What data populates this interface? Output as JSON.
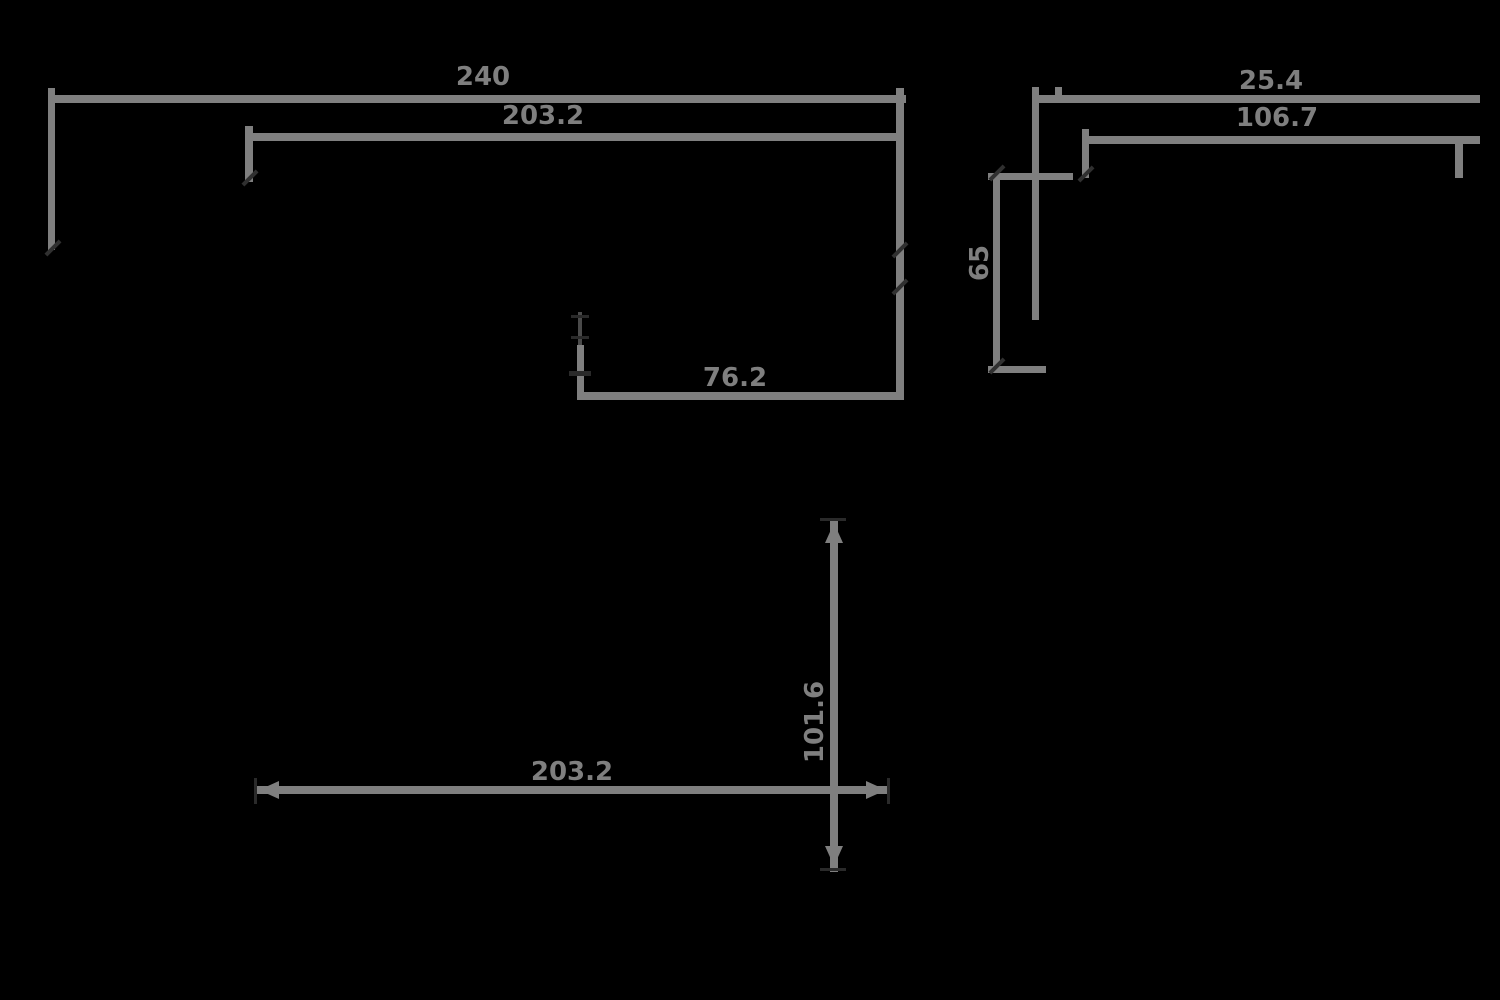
{
  "drawing": {
    "type": "mechanical-dimension-drawing",
    "colors": {
      "background": "#000000",
      "dimension_line": "#7f7f7f",
      "tick_mark": "#303030"
    },
    "views": {
      "front": {
        "overall_width_label": "240",
        "inner_width_label": "203.2",
        "bottom_feature_label": "76.2"
      },
      "side": {
        "upper_depth_label": "25.4",
        "lower_depth_label": "106.7",
        "height_label": "65"
      },
      "plan": {
        "horizontal_span_label": "203.2",
        "vertical_span_label": "101.6"
      }
    }
  }
}
